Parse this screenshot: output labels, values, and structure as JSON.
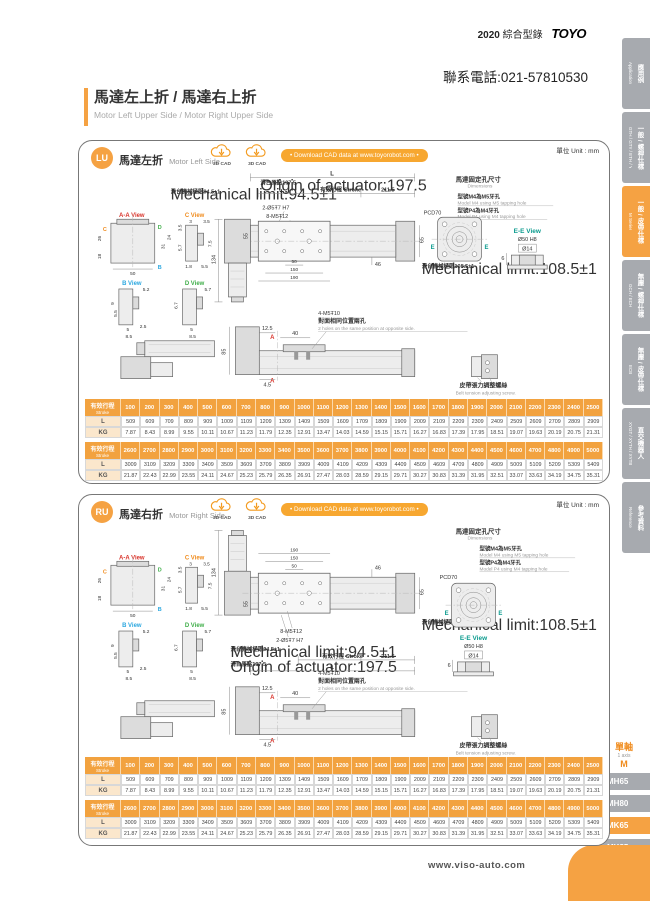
{
  "header": {
    "catalog_year": "2020",
    "catalog_zh": "綜合型錄",
    "brand": "TOYO",
    "phone": "聯系電話:021-57810530",
    "title_zh": "馬達左上折 / 馬達右上折",
    "title_en": "Motor Left Upper Side / Motor Right Upper Side"
  },
  "sidebar": {
    "tabs": [
      {
        "zh": "應用例",
        "en": "Application",
        "active": false
      },
      {
        "zh": "一般 / 螺桿仕樣",
        "en": "GTH / GTY / ETH / Y",
        "active": false
      },
      {
        "zh": "一般 / 皮帶仕樣",
        "en": "M Series",
        "active": true
      },
      {
        "zh": "無塵 / 螺桿仕樣",
        "en": "GCH / ECH",
        "active": false
      },
      {
        "zh": "無塵 / 皮帶仕樣",
        "en": "ECB",
        "active": false
      },
      {
        "zh": "直交機器人",
        "en": "XYGT / XYTH / XYTB",
        "active": false
      },
      {
        "zh": "參考資料",
        "en": "Reference",
        "active": false
      }
    ]
  },
  "model_nav": {
    "group_zh": "單軸",
    "group_en": "1 axis",
    "series": "M",
    "items": [
      {
        "label": "MH65",
        "active": false
      },
      {
        "label": "MH80",
        "active": false
      },
      {
        "label": "MK65",
        "active": true
      },
      {
        "label": "MK85",
        "active": false
      },
      {
        "label": "MK110",
        "active": false
      }
    ]
  },
  "panel_lu": {
    "badge": "LU",
    "title_zh": "馬達左折",
    "title_en": "Motor Left Side",
    "cad2d": "2D CAD",
    "cad3d": "3D CAD",
    "download": "• Download CAD data at www.toyorobot.com •",
    "unit": "單位 Unit : mm"
  },
  "panel_ru": {
    "badge": "RU",
    "title_zh": "馬達右折",
    "title_en": "Motor Right Side",
    "cad2d": "2D CAD",
    "cad3d": "3D CAD",
    "download": "• Download CAD data at www.toyorobot.com •",
    "unit": "單位 Unit : mm"
  },
  "dwg": {
    "L": "L",
    "d2115": "211.5",
    "origin_zh": "滑台原點197.5",
    "origin_en": "Origin of actuator:197.5",
    "stroke_zh": "有效行程",
    "stroke_en": "Stroke",
    "mechL_zh": "滑台機械極限94.5±1",
    "mechL_en": "Mechanical limit:94.5±1",
    "mechR_zh": "滑台機械極限108.5±1",
    "mechR_en": "Mechanical limit:108.5±1",
    "pin": "2-Ø5Ŧ7 H7",
    "tap8": "8-M5Ŧ12",
    "tap4": "4-M5Ŧ10",
    "note_zh": "對面相同位置兩孔",
    "note_en": "2 holes on the same position at opposite side.",
    "belt_zh": "皮帶張力調整螺絲",
    "belt_en": "Belt tension adjusting screw.",
    "mdim_zh": "馬達固定孔尺寸",
    "mdim_en": "Dimensions",
    "m4_zh": "型號M4為M5牙孔",
    "m4_en": "Model M4 using M5 tapping hole",
    "p4_zh": "型號P4為M4牙孔",
    "p4_en": "Model P4 using M4 tapping hole",
    "pcd": "PCD70",
    "ee": "E-E View",
    "d50h8": "Ø50 H8",
    "d14": "Ø14",
    "d6": "6",
    "vaa": "A-A View",
    "vc": "C View",
    "vb": "B View",
    "vd": "D View",
    "A": "A",
    "mk_b": "B",
    "mk_c": "C",
    "mk_d": "D",
    "mk_e": "E",
    "d134": "134",
    "d55": "55",
    "d65": "65",
    "d50": "50",
    "d150": "150",
    "d190": "190",
    "d46": "46",
    "d85": "85",
    "d125": "12.5",
    "d40": "40",
    "d45": "4.5",
    "aa": [
      "26",
      "18",
      "50",
      "31",
      "24"
    ],
    "c": [
      "3",
      "3.5",
      "3.5",
      "5.7",
      "1.8",
      "5.5",
      "7.5"
    ],
    "b": [
      "5.2",
      "9",
      "5.5",
      "5",
      "2.5",
      "8.5"
    ],
    "d": [
      "5.7",
      "6.7",
      "5",
      "8.5"
    ]
  },
  "stroke_table": {
    "header_zh": "有效行程",
    "header_en": "Stroke",
    "row_labels": [
      "L",
      "KG"
    ],
    "groups": [
      {
        "strokes": [
          "100",
          "200",
          "300",
          "400",
          "500",
          "600",
          "700",
          "800",
          "900",
          "1000",
          "1100",
          "1200",
          "1300",
          "1400",
          "1500",
          "1600",
          "1700",
          "1800",
          "1900",
          "2000",
          "2100",
          "2200",
          "2300",
          "2400",
          "2500"
        ],
        "L": [
          "509",
          "609",
          "709",
          "809",
          "909",
          "1009",
          "1109",
          "1209",
          "1309",
          "1409",
          "1509",
          "1609",
          "1709",
          "1809",
          "1909",
          "2009",
          "2109",
          "2209",
          "2309",
          "2409",
          "2509",
          "2609",
          "2709",
          "2809",
          "2909"
        ],
        "KG": [
          "7.87",
          "8.43",
          "8.99",
          "9.55",
          "10.11",
          "10.67",
          "11.23",
          "11.79",
          "12.35",
          "12.91",
          "13.47",
          "14.03",
          "14.59",
          "15.15",
          "15.71",
          "16.27",
          "16.83",
          "17.39",
          "17.95",
          "18.51",
          "19.07",
          "19.63",
          "20.19",
          "20.75",
          "21.31"
        ]
      },
      {
        "strokes": [
          "2600",
          "2700",
          "2800",
          "2900",
          "3000",
          "3100",
          "3200",
          "3300",
          "3400",
          "3500",
          "3600",
          "3700",
          "3800",
          "3900",
          "4000",
          "4100",
          "4200",
          "4300",
          "4400",
          "4500",
          "4600",
          "4700",
          "4800",
          "4900",
          "5000"
        ],
        "L": [
          "3009",
          "3109",
          "3209",
          "3309",
          "3409",
          "3509",
          "3609",
          "3709",
          "3809",
          "3909",
          "4009",
          "4109",
          "4209",
          "4309",
          "4409",
          "4509",
          "4609",
          "4709",
          "4809",
          "4909",
          "5009",
          "5109",
          "5209",
          "5309",
          "5409"
        ],
        "KG": [
          "21.87",
          "22.43",
          "22.99",
          "23.55",
          "24.11",
          "24.67",
          "25.23",
          "25.79",
          "26.35",
          "26.91",
          "27.47",
          "28.03",
          "28.59",
          "29.15",
          "29.71",
          "30.27",
          "30.83",
          "31.39",
          "31.95",
          "32.51",
          "33.07",
          "33.63",
          "34.19",
          "34.75",
          "35.31"
        ]
      }
    ]
  },
  "footer": {
    "url": "www.viso-auto.com"
  }
}
